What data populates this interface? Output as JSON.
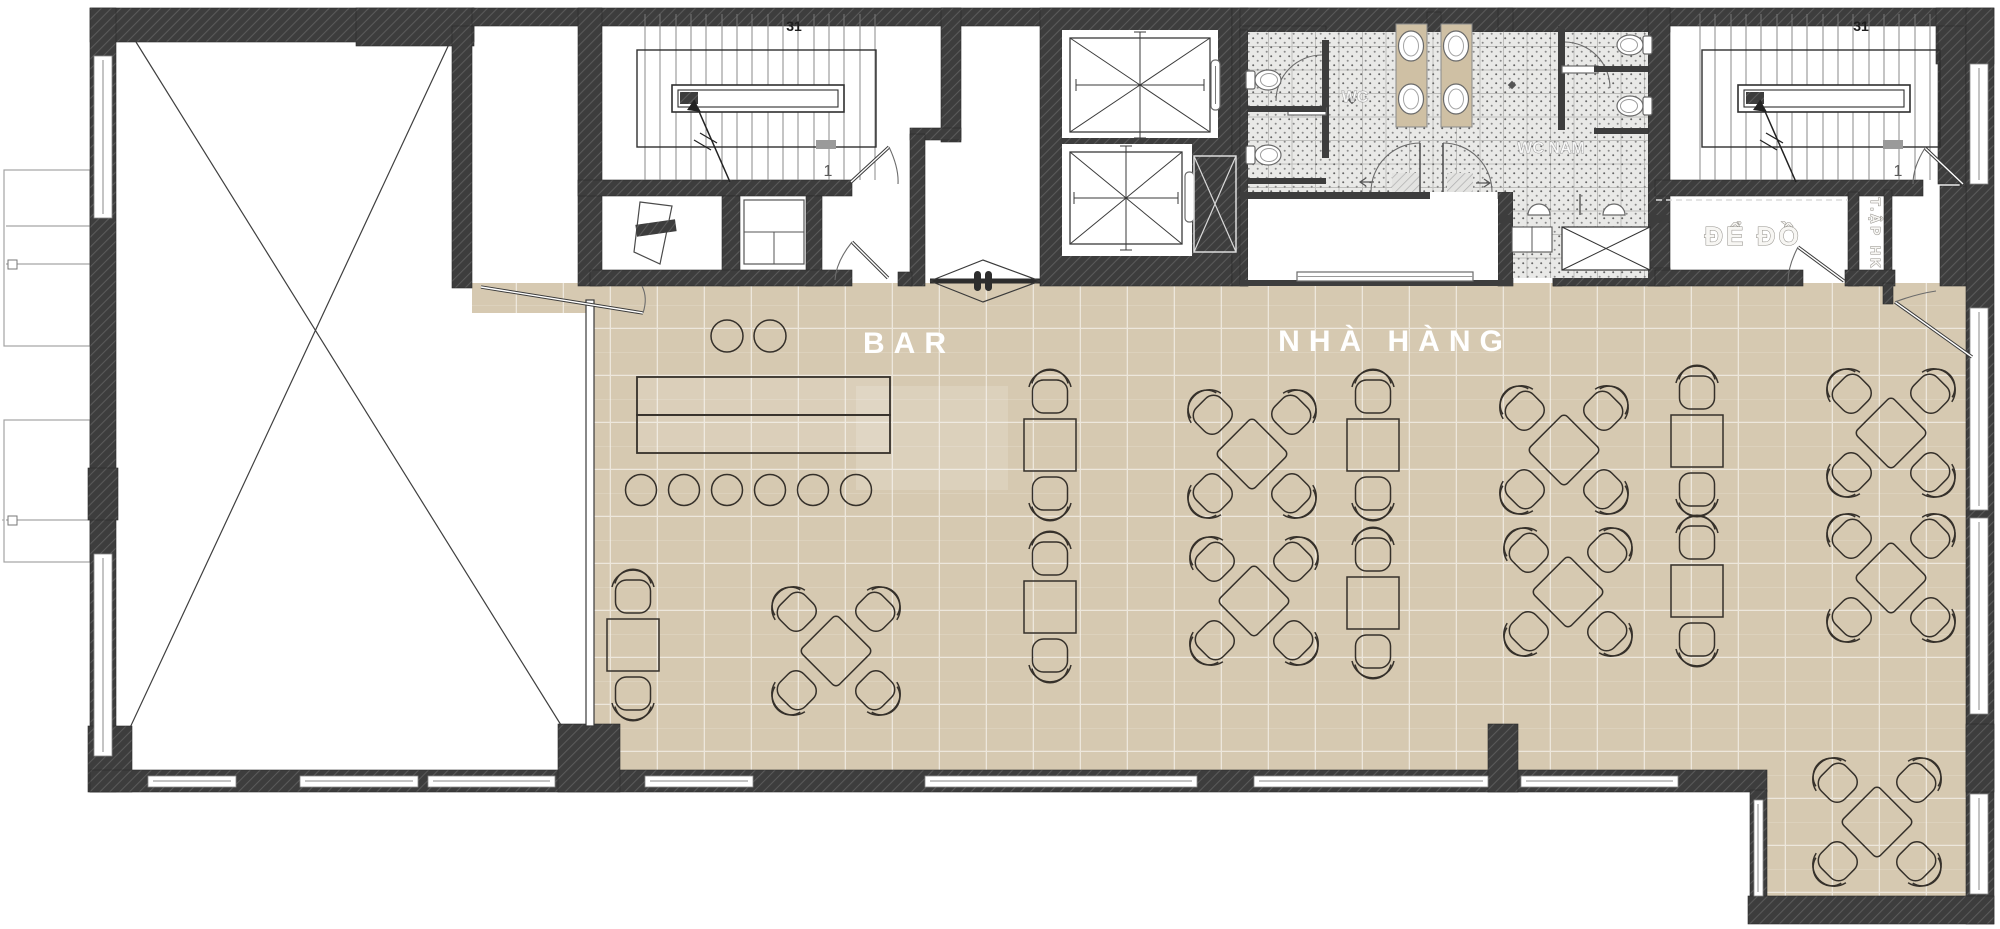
{
  "labels": {
    "bar": "BAR",
    "restaurant": "NHÀ HÀNG",
    "storage_room": "ĐỂ ĐỒ",
    "hk_shaft_top": "T.ẬP",
    "hk_shaft_bottom": "HK",
    "wc": "WC",
    "wc_men": "WC NAM",
    "stair_left": {
      "flight_count": "31",
      "exit": "1"
    },
    "stair_right": {
      "flight_count": "31",
      "exit": "1"
    }
  },
  "colors": {
    "floor_tile": "#d6c9b1",
    "floor_grout": "#e7ddcb",
    "wall_dark": "#3d3d3d",
    "wall_hatch": "#5a5a5a",
    "wc_tile": "#e9e9e7",
    "counter_beige": "#cfc0a4",
    "line_dark": "#35302a",
    "label_white": "#ffffff"
  },
  "furniture": {
    "bar_stools": [
      [
        641,
        490
      ],
      [
        684,
        490
      ],
      [
        727,
        490
      ],
      [
        770,
        490
      ],
      [
        813,
        490
      ],
      [
        856,
        490
      ]
    ],
    "round_tables": [
      [
        727,
        336
      ],
      [
        770,
        336
      ]
    ],
    "two_seat_tables": [
      [
        633,
        645
      ],
      [
        1050,
        445
      ],
      [
        1050,
        607
      ],
      [
        1373,
        445
      ],
      [
        1373,
        603
      ],
      [
        1697,
        441
      ],
      [
        1697,
        591
      ]
    ],
    "four_seat_diamond_tables": [
      [
        836,
        651
      ],
      [
        1252,
        454
      ],
      [
        1254,
        601
      ],
      [
        1564,
        450
      ],
      [
        1568,
        592
      ],
      [
        1891,
        433
      ],
      [
        1891,
        578
      ],
      [
        1877,
        822
      ]
    ],
    "wc_toilets": [
      [
        1268,
        80,
        0
      ],
      [
        1268,
        155,
        0
      ],
      [
        1630,
        45,
        180
      ],
      [
        1630,
        106,
        180
      ]
    ],
    "wc_sinks": [
      [
        1411,
        46
      ],
      [
        1411,
        99
      ],
      [
        1456,
        46
      ],
      [
        1456,
        99
      ]
    ]
  }
}
